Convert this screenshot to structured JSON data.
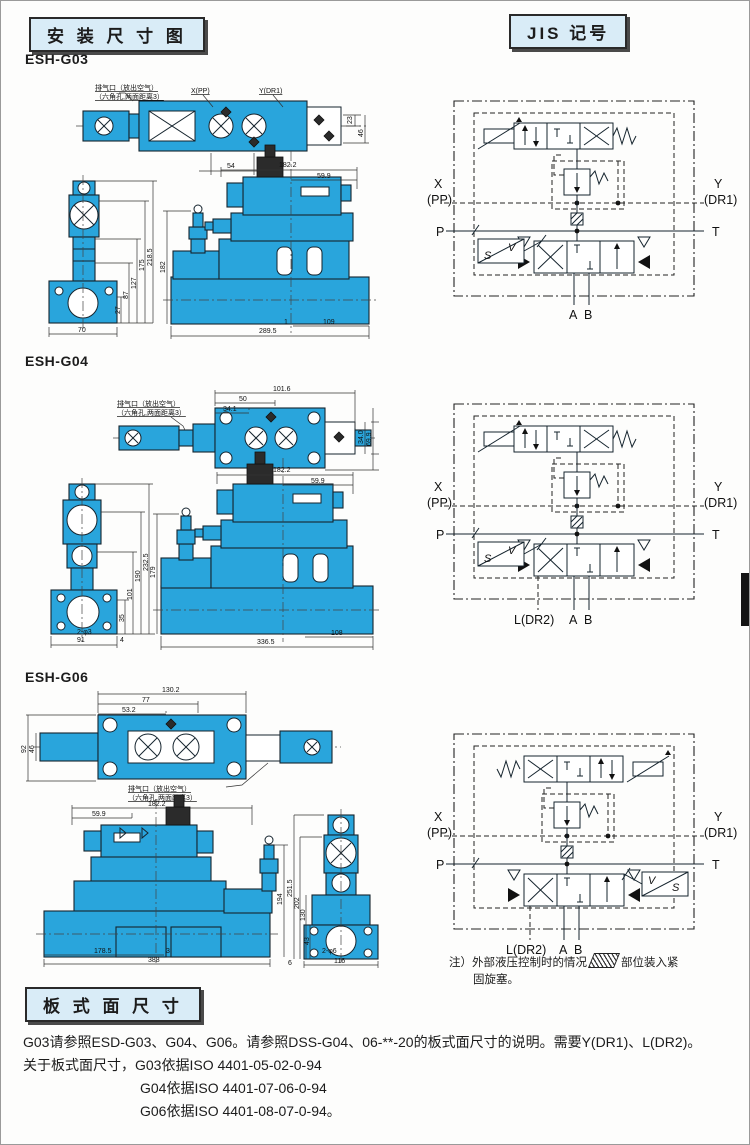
{
  "page": {
    "header_left": "安 装 尺 寸 图",
    "header_right": "JIS 记号",
    "footer_header": "板 式 面 尺 寸"
  },
  "colors": {
    "valve_blue": "#29a5dc",
    "header_bg": "#d9ecf7",
    "line": "#1c1c1c"
  },
  "note": {
    "part1": "注）外部液压控制时的情况",
    "hatch_icon": "hatched-plug-swatch",
    "part2": "部位装入紧",
    "part3": "固旋塞。"
  },
  "footer": {
    "line1": "G03请参照ESD-G03、G04、G06。请参照DSS-G04、06-**-20的板式面尺寸的说明。需要Y(DR1)、L(DR2)。",
    "line2": "关于板式面尺寸，G03依据ISO 4401-05-02-0-94",
    "line3": "G04依据ISO 4401-07-06-0-94",
    "line4": "G06依据ISO 4401-08-07-0-94。"
  },
  "sections": {
    "g03": {
      "label": "ESH-G03",
      "callout": [
        "排气口（放出空气）",
        "（六角孔,两面距离3）"
      ],
      "ports": [
        "X(PP)",
        "Y(DR1)"
      ],
      "dims": {
        "top": [
          "54",
          "23",
          "46"
        ],
        "side": [
          "70",
          "27",
          "87",
          "127",
          "175",
          "218.5"
        ],
        "front": [
          "182.2",
          "59.9",
          "182",
          "289.5",
          "1",
          "109"
        ]
      },
      "jis": {
        "x": "X",
        "pp": "(PP)",
        "y": "Y",
        "dr1": "(DR1)",
        "p": "P",
        "t": "T",
        "a": "A",
        "b": "B",
        "sv_s": "S",
        "sv_v": "V"
      }
    },
    "g04": {
      "label": "ESH-G04",
      "callout": [
        "排气口（放出空气）",
        "（六角孔,两面距离3）"
      ],
      "dims": {
        "top": [
          "101.6",
          "50",
          "34.1",
          "34.0",
          "69.9"
        ],
        "side": [
          "91",
          "2-φ3",
          "35",
          "101",
          "190",
          "232.5",
          "4"
        ],
        "front": [
          "182.2",
          "59.9",
          "179",
          "336.5",
          "108"
        ]
      },
      "jis": {
        "x": "X",
        "pp": "(PP)",
        "y": "Y",
        "dr1": "(DR1)",
        "p": "P",
        "t": "T",
        "a": "A",
        "b": "B",
        "ldr2": "L(DR2)",
        "sv_s": "S",
        "sv_v": "V"
      }
    },
    "g06": {
      "label": "ESH-G06",
      "callout": [
        "排气口（放出空气）",
        "（六角孔,两面距离3）"
      ],
      "dims": {
        "top": [
          "130.2",
          "77",
          "53.2",
          "92",
          "46"
        ],
        "front": [
          "182.2",
          "59.9",
          "194",
          "178.5",
          "3",
          "388"
        ],
        "side": [
          "251.5",
          "202",
          "130",
          "43",
          "6",
          "2-φ6",
          "116"
        ]
      },
      "jis": {
        "x": "X",
        "pp": "(PP)",
        "y": "Y",
        "dr1": "(DR1)",
        "p": "P",
        "t": "T",
        "a": "A",
        "b": "B",
        "ldr2": "L(DR2)",
        "sv_v": "V",
        "sv_s": "S"
      }
    }
  }
}
